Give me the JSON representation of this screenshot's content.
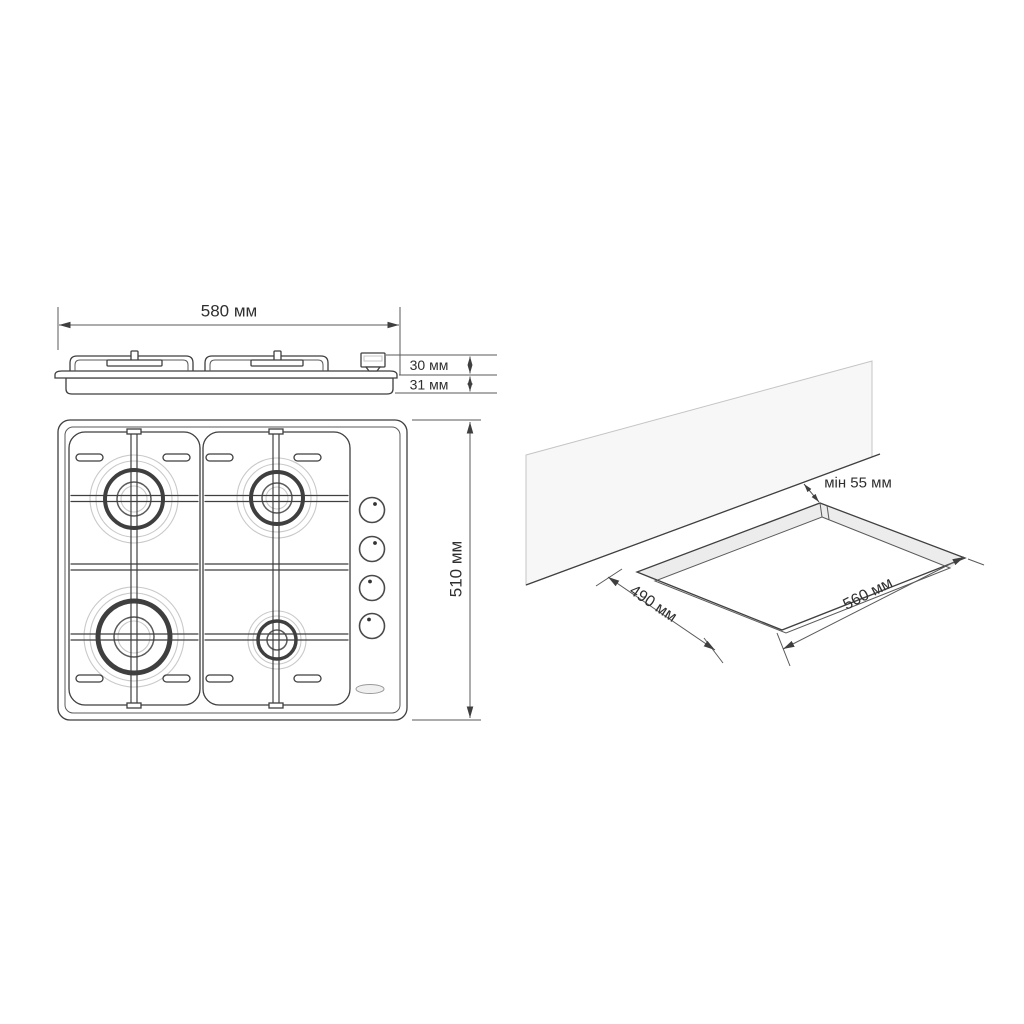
{
  "colors": {
    "line": "#3f3f3f",
    "light_line": "#c9c9c9",
    "wall_fill": "#f7f7f7",
    "wall_stroke": "#c4c4c4",
    "strip_fill": "#ececec",
    "text": "#2f2f2f",
    "background": "#ffffff"
  },
  "side_view": {
    "width_dimension": "580 мм",
    "height_above_counter": "30 мм",
    "height_below_counter": "31 мм"
  },
  "top_view": {
    "depth_dimension": "510 мм",
    "burner_count": "4",
    "knob_count": "4"
  },
  "installation_view": {
    "min_wall_distance": "мін 55 мм",
    "cutout_depth": "490 мм",
    "cutout_width": "560 мм"
  }
}
